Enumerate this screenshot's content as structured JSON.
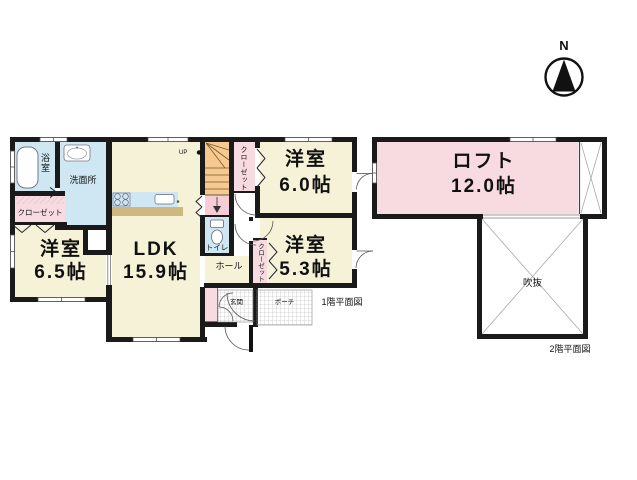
{
  "colors": {
    "wall": "#1a1a1a",
    "room_yellow": "#f6f2d8",
    "water_cyan": "#cfe7f2",
    "pink": "#f8dbe1",
    "stair_orange": "#f5c98f",
    "landing_pink": "#f6ccd5",
    "counter_tan": "#cdb97f"
  },
  "compass": {
    "label": "N"
  },
  "floor1": {
    "caption": "1階平面図",
    "rooms": {
      "bath": {
        "label": "浴室"
      },
      "washroom": {
        "label": "洗面所"
      },
      "closet_bath": {
        "label": "クローゼット"
      },
      "bedroom_65": {
        "name": "洋室",
        "size": "6.5帖"
      },
      "ldk": {
        "name": "LDK",
        "size": "15.9帖"
      },
      "stairs": {
        "label": "UP"
      },
      "toilet": {
        "label": "トイレ"
      },
      "hall": {
        "label": "ホール"
      },
      "closet_stairs": {
        "label": "クローゼット"
      },
      "bedroom_60": {
        "name": "洋室",
        "size": "6.0帖"
      },
      "closet_53": {
        "label": "クローゼット"
      },
      "bedroom_53": {
        "name": "洋室",
        "size": "5.3帖"
      },
      "entrance": {
        "label": "玄関"
      },
      "porch": {
        "label": "ポーチ"
      }
    }
  },
  "floor2": {
    "caption": "2階平面図",
    "rooms": {
      "loft": {
        "name": "ロフト",
        "size": "12.0帖"
      },
      "void": {
        "label": "吹抜"
      }
    }
  }
}
